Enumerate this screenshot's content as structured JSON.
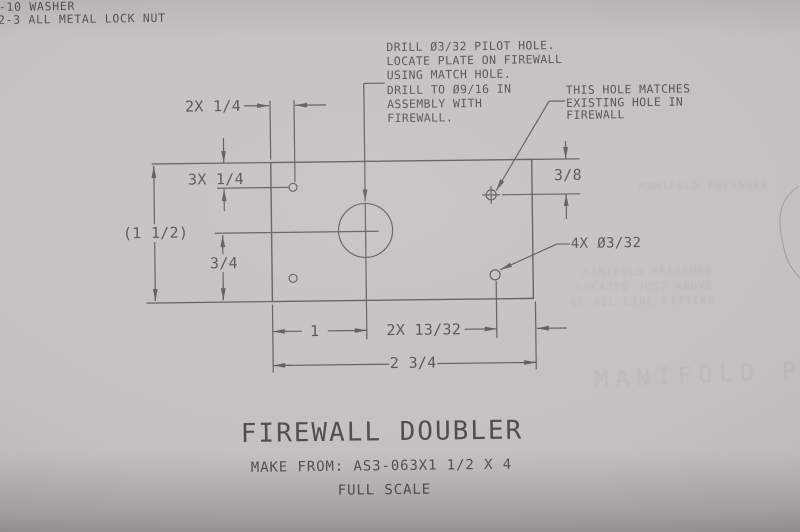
{
  "colors": {
    "paper": "#c5c1c2",
    "ink": "#5f5c60",
    "text": "#55525a",
    "ghost": "#8e8a8c"
  },
  "parts_list": {
    "line1": "-10 WASHER",
    "line2": "2-3 ALL METAL LOCK NUT"
  },
  "drill_note": {
    "line1": "DRILL Ø3/32 PILOT HOLE.",
    "line2": "LOCATE PLATE ON FIREWALL",
    "line3": "USING MATCH HOLE.",
    "line4": "DRILL TO Ø9/16 IN",
    "line5": "ASSEMBLY WITH",
    "line6": "FIREWALL."
  },
  "hole_note": {
    "line1": "THIS HOLE MATCHES",
    "line2": "EXISTING HOLE IN",
    "line3": "FIREWALL"
  },
  "callouts": {
    "pilot_holes": "4X Ø3/32"
  },
  "dimensions": {
    "top_hole_offset": "2X 1/4",
    "upper_left": "3X 1/4",
    "overall_height": "(1 1/2)",
    "lower_left": "3/4",
    "right": "3/8",
    "bottom_first": "1",
    "bottom_second": "2X 13/32",
    "bottom_overall": "2 3/4"
  },
  "title_block": {
    "title": "FIREWALL DOUBLER",
    "make_from": "MAKE FROM: AS3-063X1 1/2 X 4",
    "scale": "FULL SCALE"
  },
  "ghost_bleedthrough": {
    "line0": "MANIFOLD PRESSURE",
    "line1": "MANIFOLD PRESSURE",
    "line2": "LOCATED JUST ABOVE",
    "line3": "OF OIL LINE FITTING",
    "big": "MANIFOLD PR"
  }
}
